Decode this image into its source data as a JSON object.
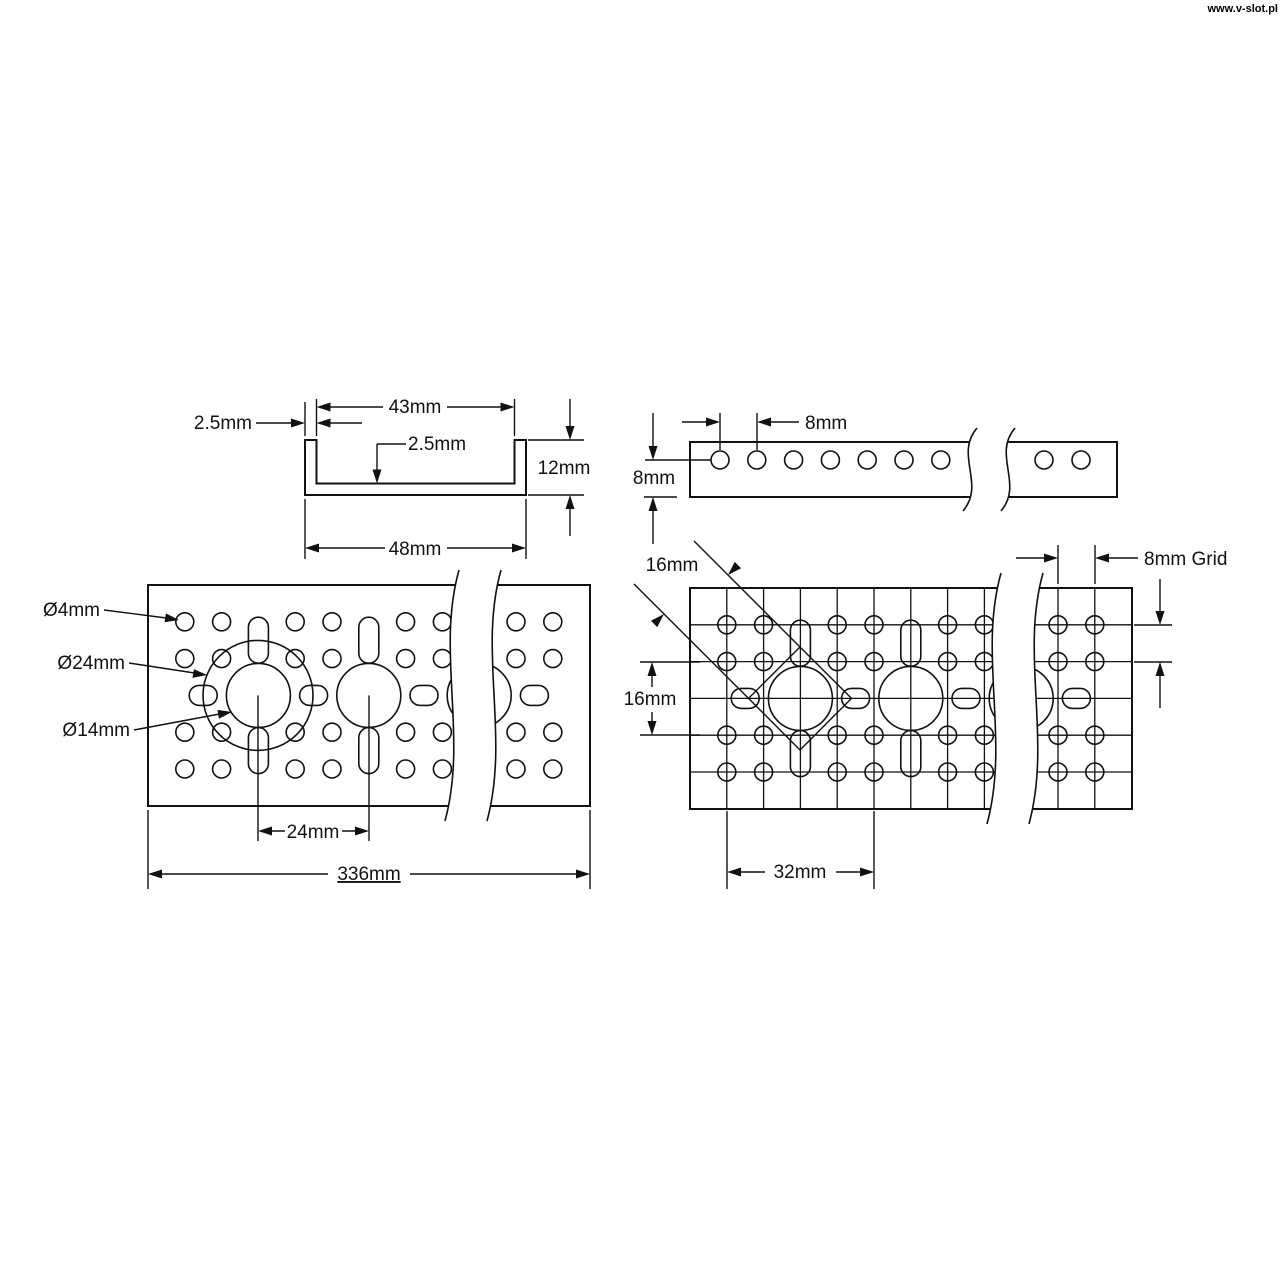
{
  "watermark": {
    "text": "www.v-slot.pl"
  },
  "views": {
    "cross_section": {
      "title": "u-channel-cross-section",
      "dims": {
        "inner_width": "43mm",
        "wall": "2.5mm",
        "floor": "2.5mm",
        "height": "12mm",
        "outer_width": "48mm"
      }
    },
    "side_view": {
      "title": "channel-side-view",
      "dims": {
        "hole_pitch": "8mm",
        "edge_offset": "8mm"
      }
    },
    "top_view": {
      "title": "channel-top-view",
      "labels": {
        "small_hole": "Ø4mm",
        "bolt_circle": "Ø24mm",
        "center_hole": "Ø14mm"
      },
      "dims": {
        "hole_spacing": "24mm",
        "total_length": "336mm"
      }
    },
    "grid_view": {
      "title": "hole-pattern-grid-view",
      "dims": {
        "diamond_side": "16mm",
        "row_span": "16mm",
        "grid_label": "8mm Grid",
        "cluster_span": "32mm"
      }
    }
  }
}
